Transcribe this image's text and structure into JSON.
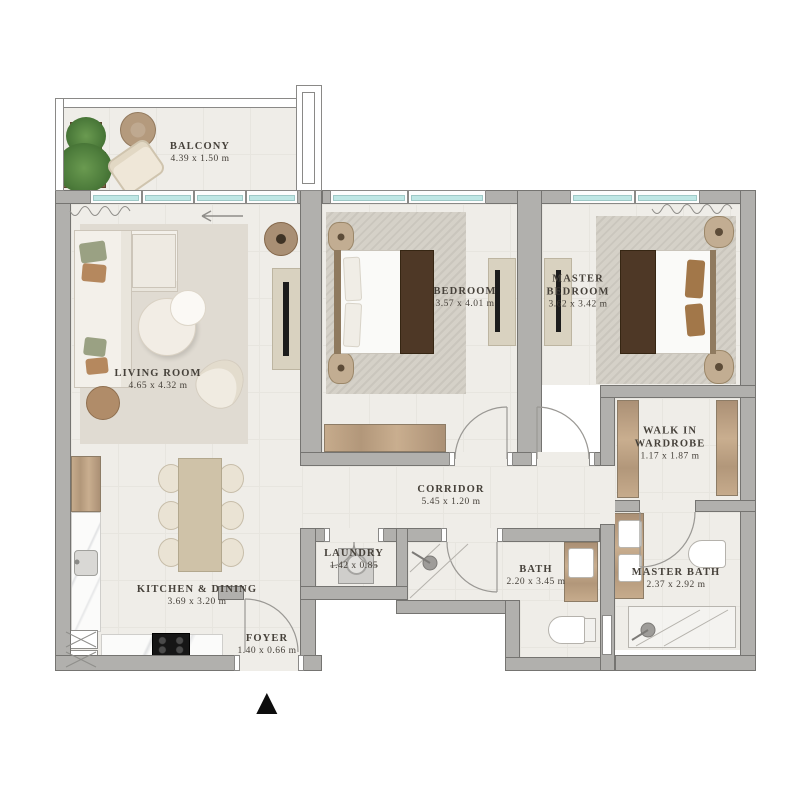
{
  "rooms": {
    "balcony": {
      "name": "BALCONY",
      "dims": "4.39 x 1.50 m"
    },
    "living_room": {
      "name": "LIVING ROOM",
      "dims": "4.65 x 4.32 m"
    },
    "bedroom": {
      "name": "BEDROOM",
      "dims": "3.57 x 4.01 m"
    },
    "master_bedroom": {
      "name": "MASTER BEDROOM",
      "dims": "3.62 x 3.42 m"
    },
    "walk_in_wardrobe": {
      "name": "WALK IN WARDROBE",
      "dims": "1.17 x 1.87 m"
    },
    "corridor": {
      "name": "CORRIDOR",
      "dims": "5.45 x 1.20 m"
    },
    "laundry": {
      "name": "LAUNDRY",
      "dims": "1.42  x 0.85"
    },
    "kitchen_dining": {
      "name": "KITCHEN & DINING",
      "dims": "3.69 x 3.20 m"
    },
    "foyer": {
      "name": "FOYER",
      "dims": "1.40 x 0.66 m"
    },
    "bath": {
      "name": "BATH",
      "dims": "2.20 x 3.45 m"
    },
    "master_bath": {
      "name": "MASTER BATH",
      "dims": "2.37 x 2.92 m"
    }
  },
  "entrance_marker": "▲",
  "colors": {
    "wall": "#b1b0ad",
    "floor": "#efede8",
    "rug": "#d9d4cb",
    "wood": "#bb9f81",
    "dark_wood": "#4e3826",
    "window_glass": "#bfe7e5",
    "label_text": "#46413a",
    "plant": "#4e7d3c",
    "marker": "#111111"
  }
}
